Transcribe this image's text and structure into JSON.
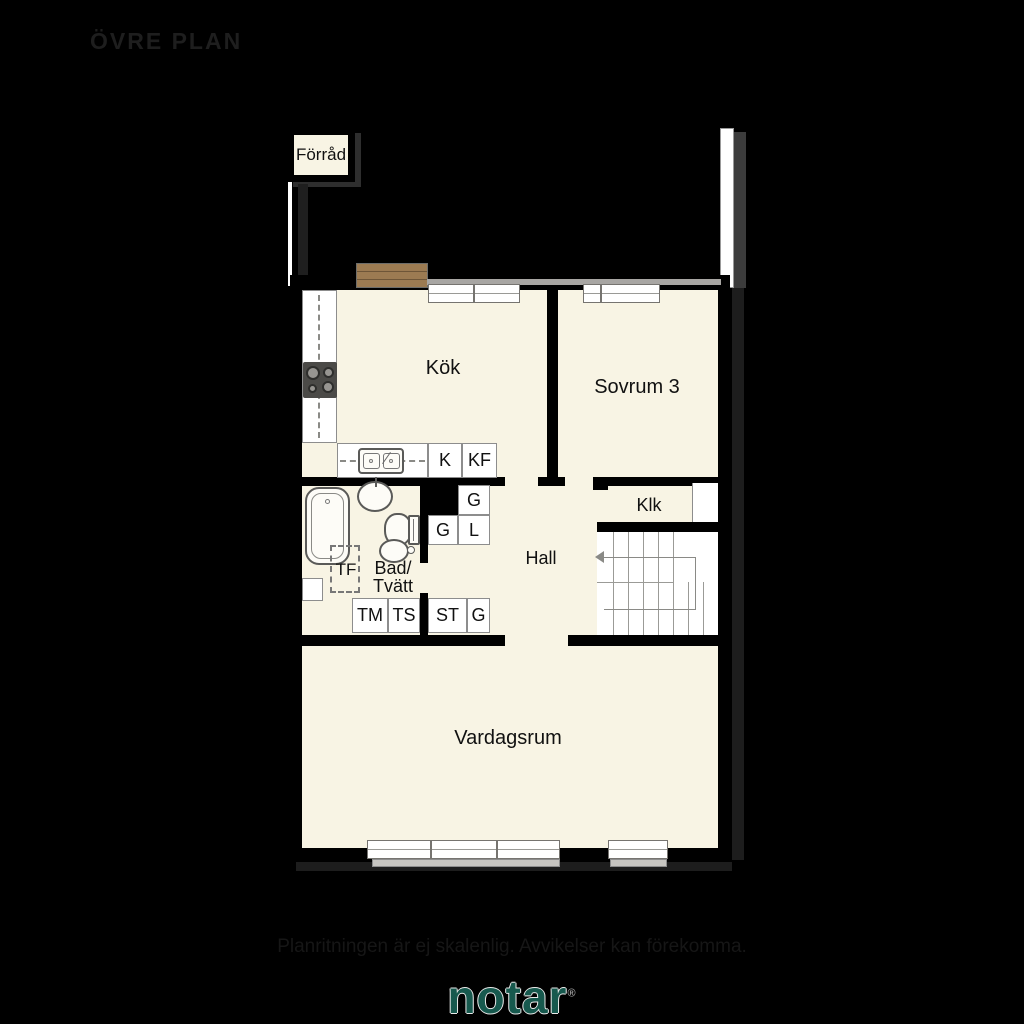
{
  "header": {
    "plan_title": "ÖVRE PLAN"
  },
  "rooms": {
    "forrad": "Förråd",
    "kok": "Kök",
    "sovrum3": "Sovrum 3",
    "klk": "Klk",
    "hall": "Hall",
    "bad_line1": "Bad/",
    "bad_line2": "Tvätt",
    "vardagsrum": "Vardagsrum"
  },
  "closets": {
    "k": "K",
    "kf": "KF",
    "g_upper": "G",
    "g_mid": "G",
    "l": "L",
    "tm": "TM",
    "ts": "TS",
    "st": "ST",
    "g_hall": "G"
  },
  "fixtures": {
    "tf_label": "TF"
  },
  "footer": {
    "disclaimer": "Planritningen är ej skalenlig. Avvikelser kan förekomma.",
    "brand": "notar",
    "registered_mark": "®"
  },
  "colors": {
    "room_fill": "#f8f4e4",
    "brand_green": "#17594e",
    "background": "#000000"
  }
}
